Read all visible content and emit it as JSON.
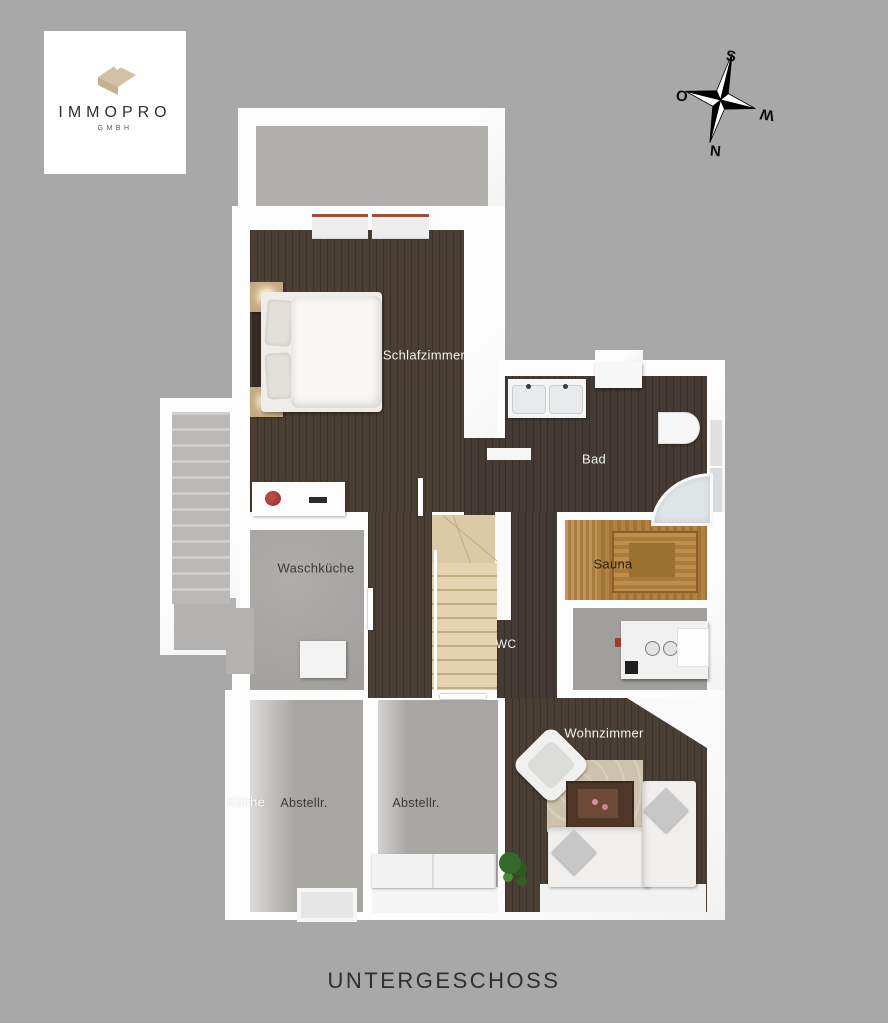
{
  "page": {
    "title": "UNTERGESCHOSS",
    "background": "#a8a8a8"
  },
  "logo": {
    "company": "IMMOPRO",
    "legal": "GMBH",
    "icon": "roof-icon",
    "accent": "#d2c1a4"
  },
  "compass": {
    "top": "S",
    "left": "O",
    "right": "W",
    "bottom": "N"
  },
  "floorplan": {
    "rooms": [
      {
        "id": "schlafzimmer",
        "label": "Schlafzimmer"
      },
      {
        "id": "bad",
        "label": "Bad"
      },
      {
        "id": "sauna",
        "label": "Sauna"
      },
      {
        "id": "waschkueche",
        "label": "Waschküche"
      },
      {
        "id": "wc",
        "label": "WC"
      },
      {
        "id": "wohnzimmer",
        "label": "Wohnzimmer"
      },
      {
        "id": "kueche",
        "label": "Küche"
      },
      {
        "id": "abstellraum-links",
        "label": "Abstellr."
      },
      {
        "id": "abstellraum-rechts",
        "label": "Abstellr."
      }
    ]
  },
  "colors": {
    "background": "#a8a8a8",
    "wall": "#fbfbfb",
    "wood_floor": "#473b31",
    "concrete_floor": "#a9a7a4",
    "sauna_wood": "#b1833f",
    "stair_wood": "#dcc9a5",
    "title_text": "#2f2f2f",
    "window_frame_red": "#9e4f3b"
  }
}
